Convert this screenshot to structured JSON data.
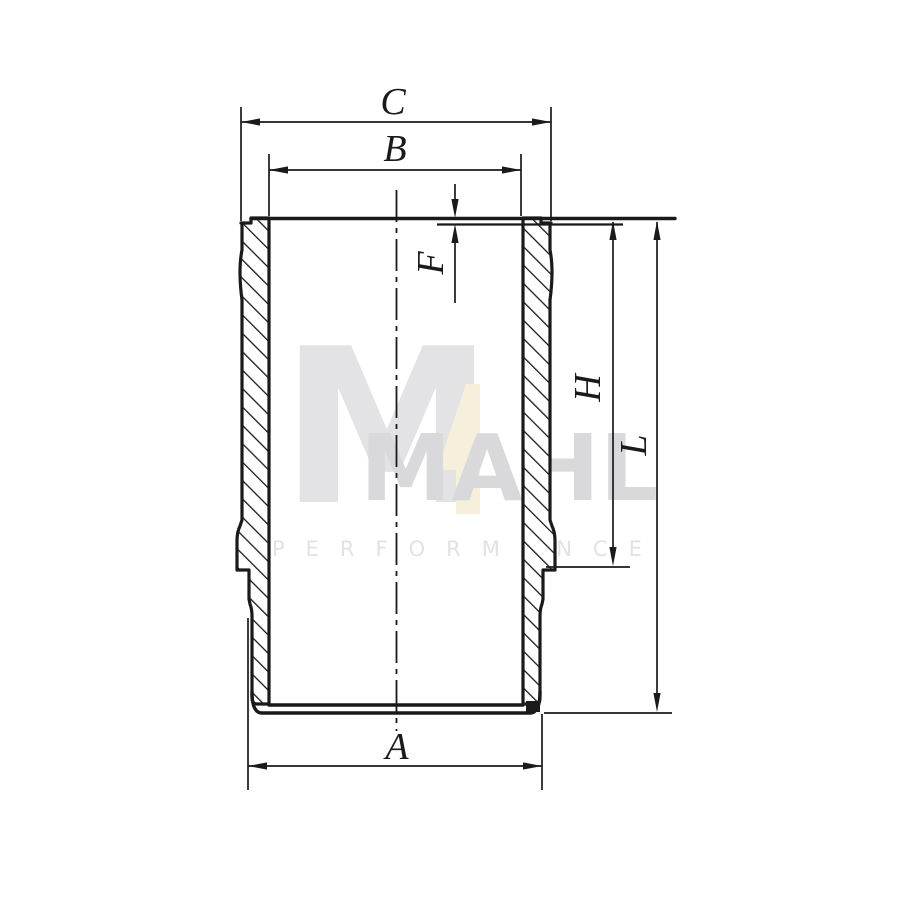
{
  "drawing": {
    "labels": {
      "C": "C",
      "B": "B",
      "F": "F",
      "H": "H",
      "L": "L",
      "A": "A"
    }
  },
  "watermark": {
    "logo_letter": "M",
    "numeral": "4",
    "wordmark": "MAHL",
    "tagline": "PERFORMANCE"
  },
  "colors": {
    "line": "#1a1a1c",
    "background": "#ffffff",
    "watermark_gray": "#e3e3e5",
    "wordmark_gray": "#d9d9db",
    "tagline_gray": "#e2e2e4",
    "numeral_cream": "#f5efdb"
  }
}
